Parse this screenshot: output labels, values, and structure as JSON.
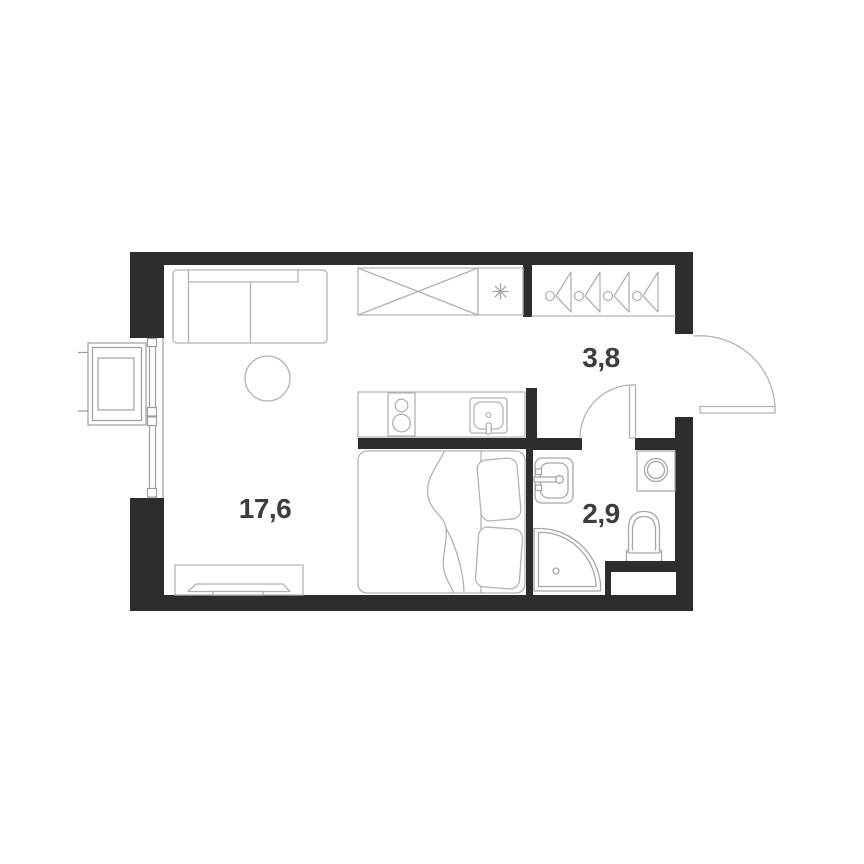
{
  "canvas": {
    "width": 864,
    "height": 864
  },
  "colors": {
    "background_color": "#ffffff",
    "wall_color": "#2d2d2d",
    "furniture_line_color": "#b3b3b3",
    "fixture_line_color": "#a6a6a6",
    "window_line_color": "#9e9e9e",
    "label_color": "#3d3d3d"
  },
  "plan": {
    "type": "studio-apartment-floor-plan",
    "rooms": {
      "living_room": {
        "label": "17,6"
      },
      "hallway": {
        "label": "3,8"
      },
      "bathroom": {
        "label": "2,9"
      }
    },
    "icons": [
      "sofa",
      "round-table",
      "tv-stand",
      "wardrobe-crossed-box",
      "asterisk-appliance-spot",
      "coat-hanger-icon",
      "kitchen-counter",
      "two-burner-stove",
      "kitchen-sink",
      "double-bed",
      "pillow",
      "blanket",
      "washbasin",
      "washing-machine",
      "toilet",
      "corner-shower",
      "ventilation-shaft",
      "window",
      "balcony-box",
      "entrance-door-swing",
      "bathroom-door-swing"
    ],
    "hanger_count": 4
  }
}
